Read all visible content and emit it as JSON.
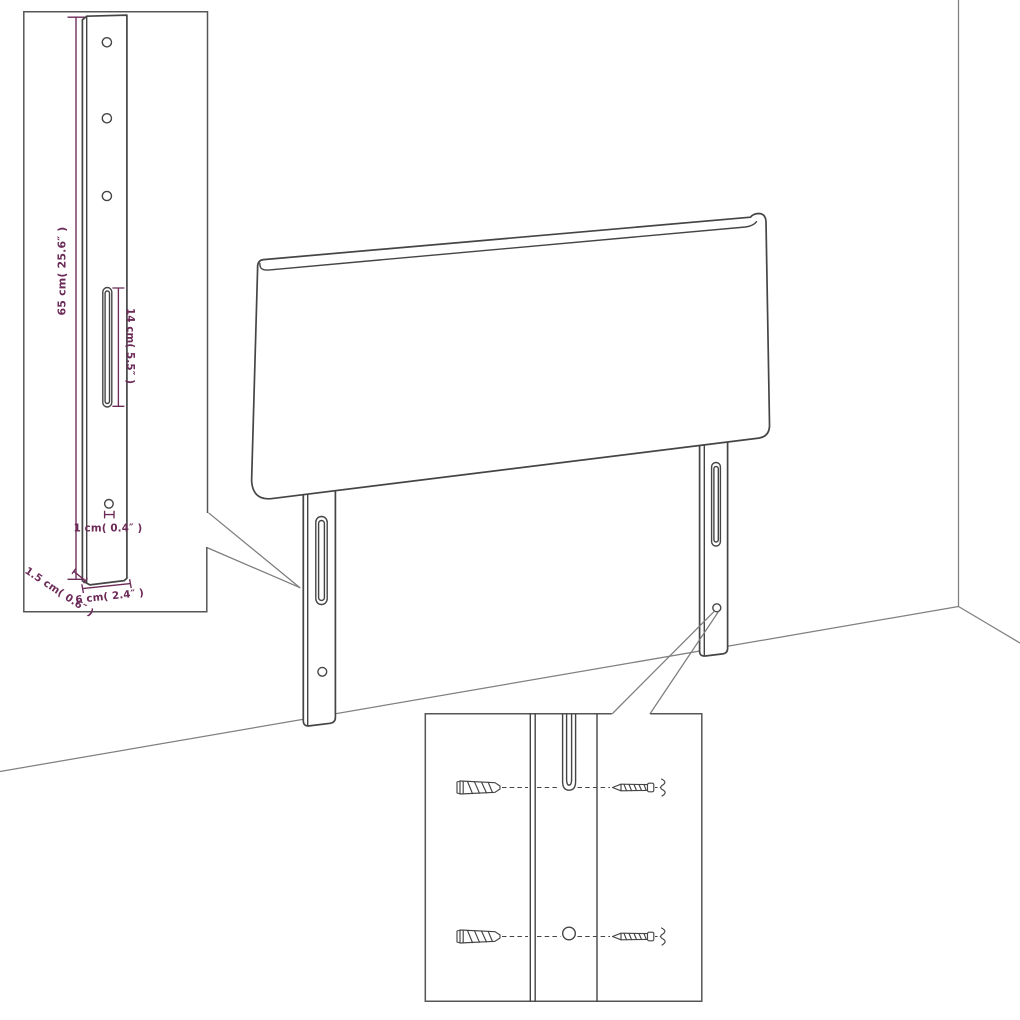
{
  "colors": {
    "background": "#ffffff",
    "line": "#454545",
    "wall_line": "#808080",
    "inset_border": "#565656",
    "callout_line": "#7d7d7d",
    "dimension": "#6b2a58"
  },
  "dims": {
    "height": "65 cm( 25.6″ )",
    "slot": "14 cm( 5.5″ )",
    "hole": "1 cm( 0.4″ )",
    "depth": "1.5 cm( 0.6″ )",
    "width": "6 cm( 2.4″ )"
  }
}
